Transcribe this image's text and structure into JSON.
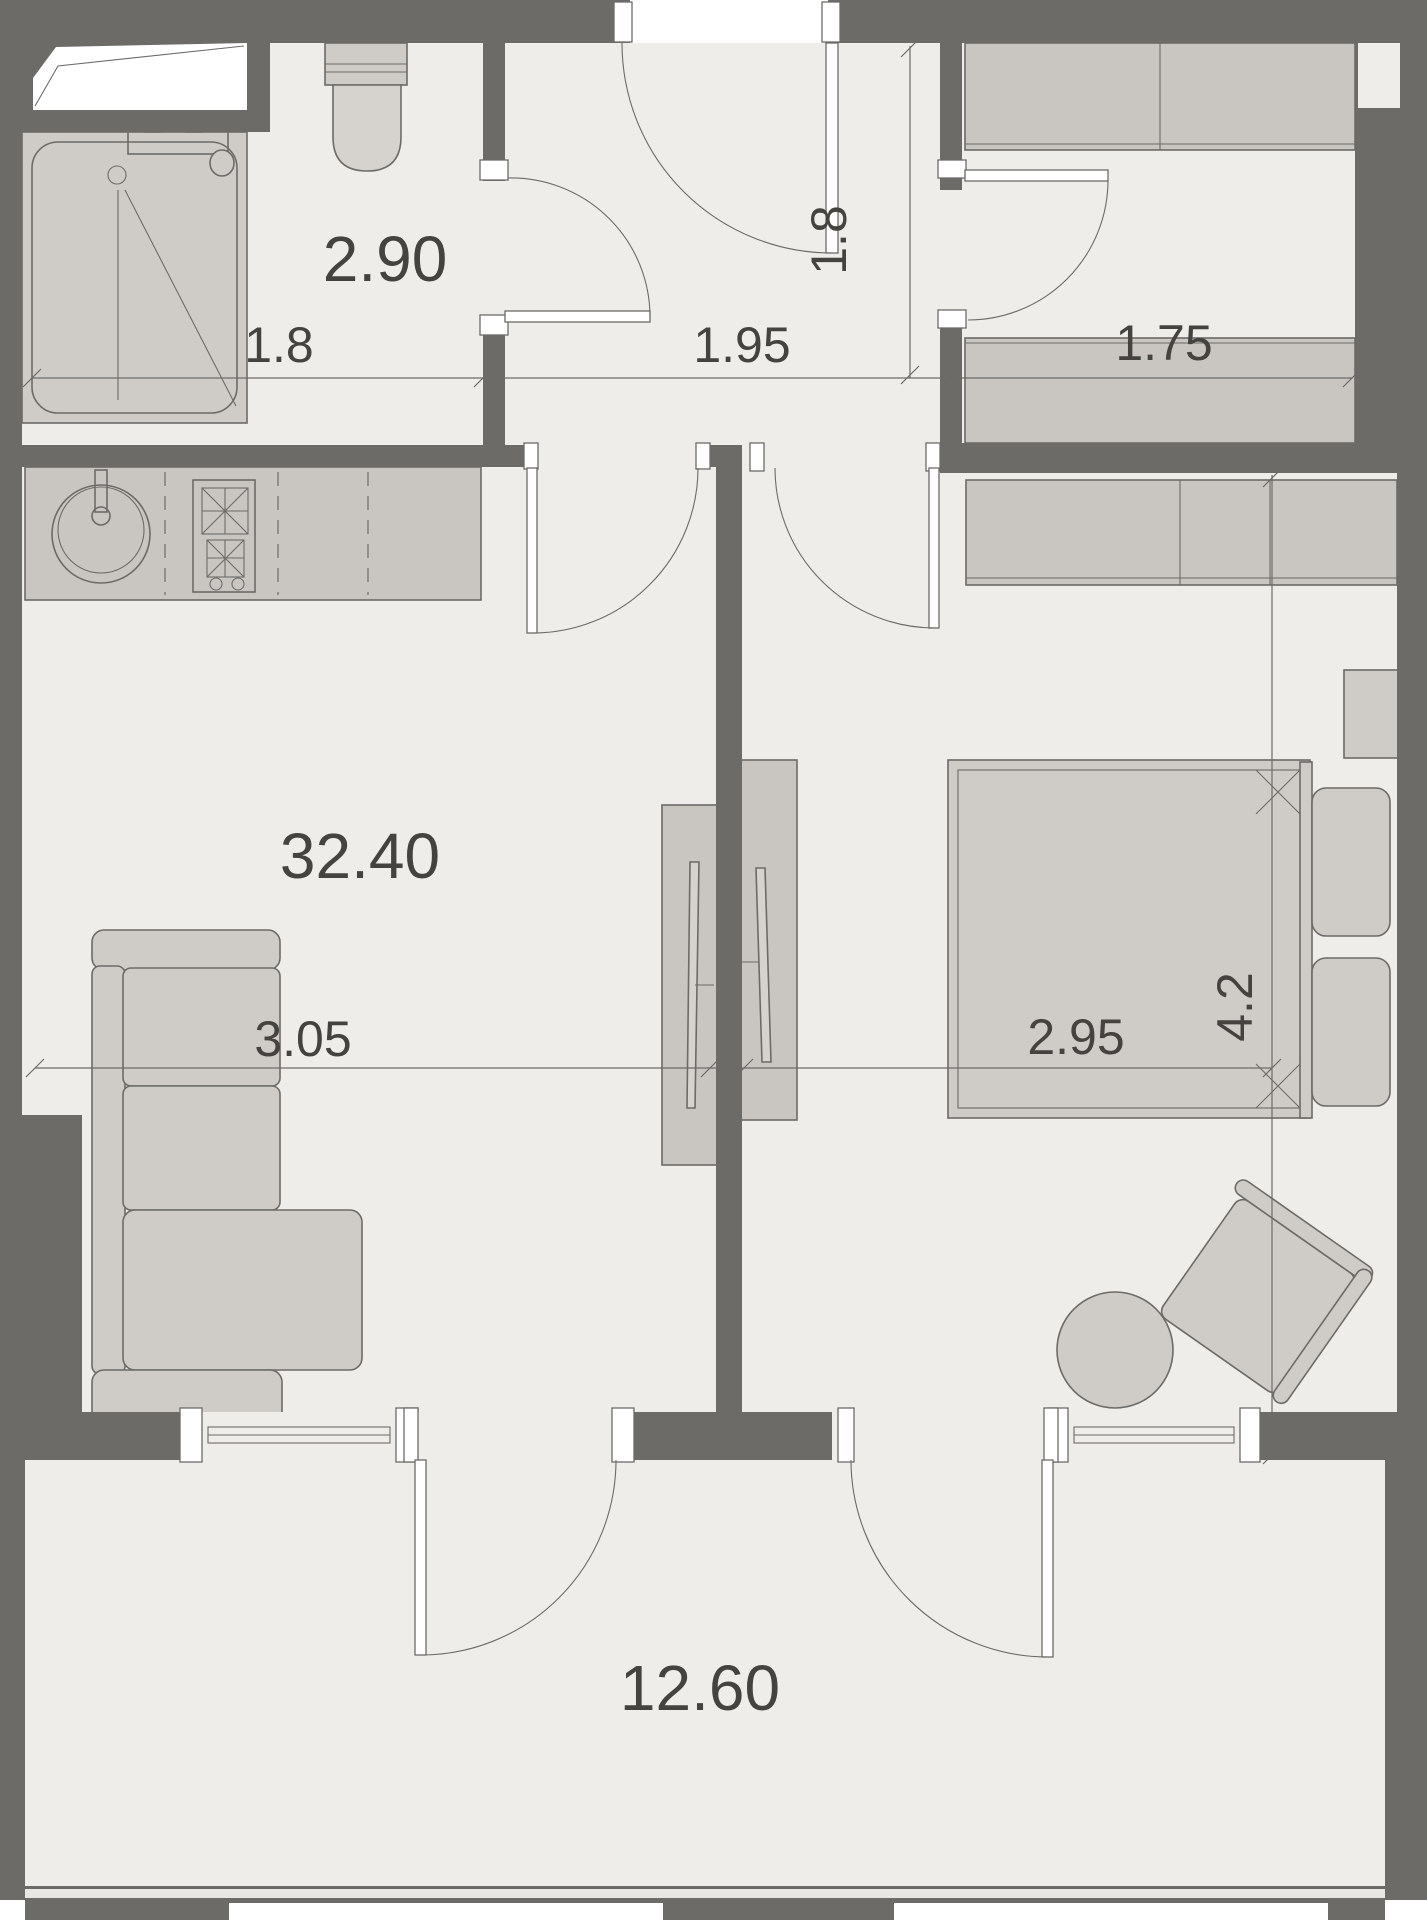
{
  "plan": {
    "kind": "apartment-floor-plan",
    "canvas_width": 1427,
    "canvas_height": 1920
  },
  "colors": {
    "wall": "#6d6b68",
    "floor": "#efedea",
    "furniture": "#cfccc7",
    "furniture_light": "#d6d3ce",
    "cabinet": "#c9c6c1",
    "outline": "#6d6b68",
    "railing": "#e9e7e3",
    "text": "#454340",
    "exterior": "#ffffff"
  },
  "labels": {
    "bathroom_area": "2.90",
    "bathroom_width": "1.8",
    "hallway_width": "1.95",
    "storage_width": "1.75",
    "entry_depth": "1.8",
    "living_area": "32.40",
    "living_width": "3.05",
    "bedroom_width": "2.95",
    "bedroom_depth": "4.2",
    "balcony_area": "12.60"
  },
  "rooms": [
    {
      "name": "bathroom",
      "label_key": "bathroom_area"
    },
    {
      "name": "hallway",
      "label_key": "hallway_width"
    },
    {
      "name": "storage",
      "label_key": "storage_width"
    },
    {
      "name": "living-kitchen",
      "label_key": "living_area"
    },
    {
      "name": "bedroom",
      "label_key": "bedroom_width"
    },
    {
      "name": "balcony",
      "label_key": "balcony_area"
    }
  ]
}
